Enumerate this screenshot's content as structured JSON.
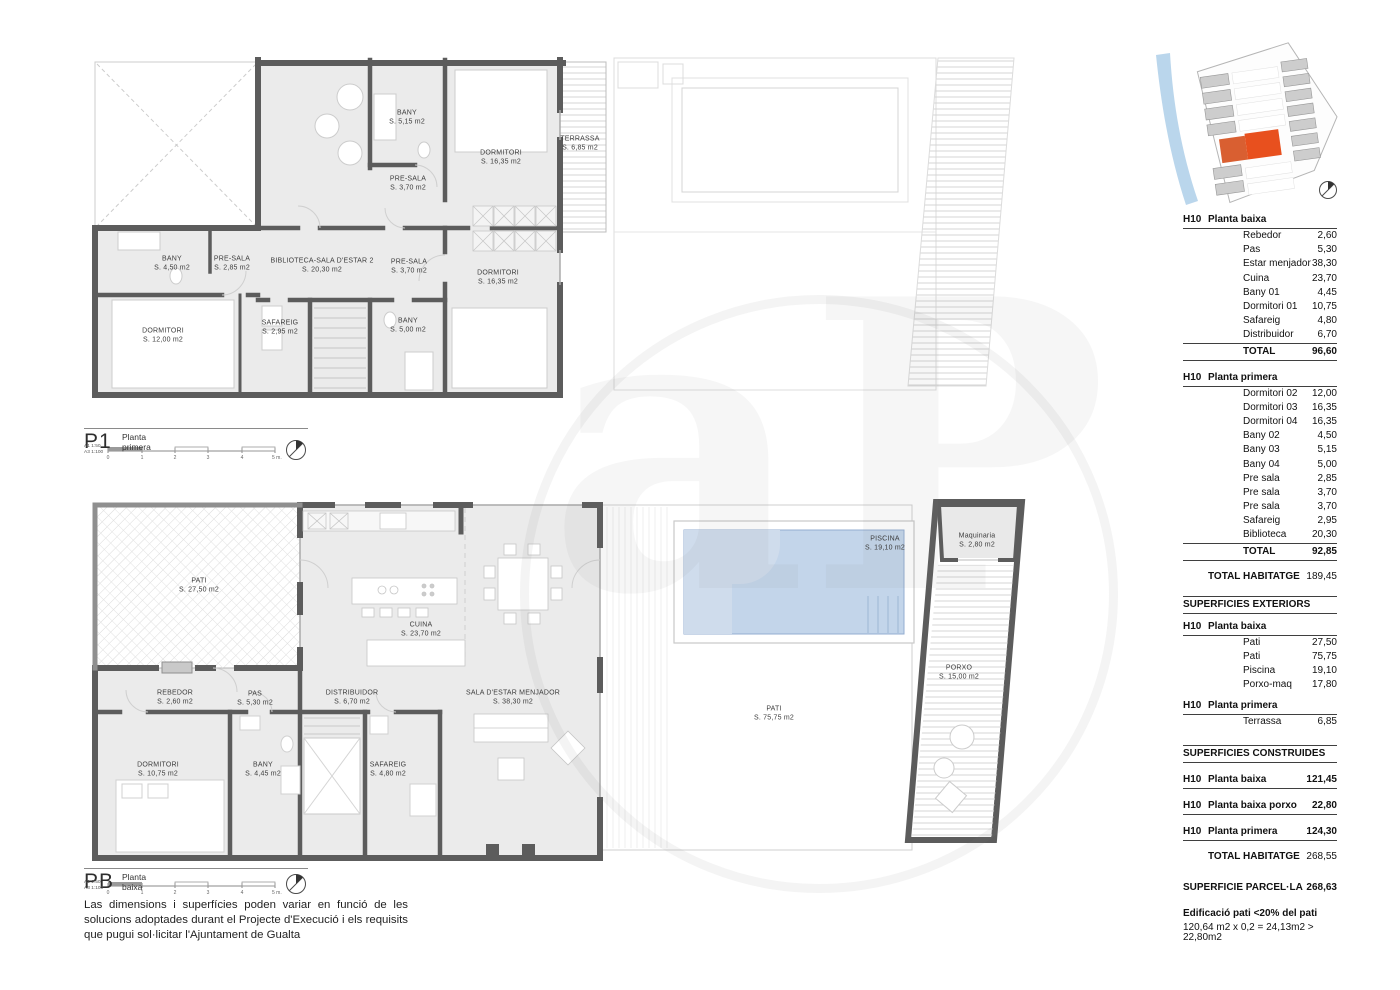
{
  "watermark": {
    "text": "aP"
  },
  "colors": {
    "wall": "#5c5c5c",
    "room_fill": "#ebebeb",
    "pool": "#c3d5ea",
    "highlight_orange": "#e8511f",
    "river_blue": "#b3d1ea"
  },
  "plans": {
    "p1": {
      "code": "P1",
      "title": "Planta primera",
      "scale_a1": "A1  1:50",
      "scale_a3": "A3  1:100",
      "ticks": [
        "0",
        "1",
        "2",
        "3",
        "4",
        "5 m."
      ],
      "rooms": [
        {
          "name": "BANY",
          "area": "S. 5,15 m2"
        },
        {
          "name": "DORMITORI",
          "area": "S. 16,35 m2"
        },
        {
          "name": "TERRASSA",
          "area": "S. 6,85 m2"
        },
        {
          "name": "PRE-SALA",
          "area": "S. 3,70 m2"
        },
        {
          "name": "BANY",
          "area": "S. 4,50 m2"
        },
        {
          "name": "PRE-SALA",
          "area": "S. 2,85 m2"
        },
        {
          "name": "BIBLIOTECA-SALA D'ESTAR 2",
          "area": "S. 20,30 m2"
        },
        {
          "name": "PRE-SALA",
          "area": "S. 3,70 m2"
        },
        {
          "name": "DORMITORI",
          "area": "S. 16,35 m2"
        },
        {
          "name": "DORMITORI",
          "area": "S. 12,00 m2"
        },
        {
          "name": "SAFAREIG",
          "area": "S. 2,95 m2"
        },
        {
          "name": "BANY",
          "area": "S. 5,00 m2"
        }
      ]
    },
    "pb": {
      "code": "PB",
      "title": "Planta baixa",
      "scale_a1": "A1  1:50",
      "scale_a3": "A3  1:100",
      "ticks": [
        "0",
        "1",
        "2",
        "3",
        "4",
        "5 m."
      ],
      "rooms": [
        {
          "name": "PATI",
          "area": "S. 27,50 m2"
        },
        {
          "name": "PISCINA",
          "area": "S. 19,10 m2"
        },
        {
          "name": "Maquinaria",
          "area": "S. 2,80 m2"
        },
        {
          "name": "CUINA",
          "area": "S. 23,70 m2"
        },
        {
          "name": "REBEDOR",
          "area": "S. 2,60 m2"
        },
        {
          "name": "PAS",
          "area": "S. 5,30 m2"
        },
        {
          "name": "DISTRIBUIDOR",
          "area": "S. 6,70 m2"
        },
        {
          "name": "SALA D'ESTAR MENJADOR",
          "area": "S. 38,30 m2"
        },
        {
          "name": "PATI",
          "area": "S. 75,75 m2"
        },
        {
          "name": "PORXO",
          "area": "S. 15,00 m2"
        },
        {
          "name": "DORMITORI",
          "area": "S. 10,75 m2"
        },
        {
          "name": "BANY",
          "area": "S. 4,45 m2"
        },
        {
          "name": "SAFAREIG",
          "area": "S. 4,80 m2"
        }
      ]
    }
  },
  "disclaimer": "Las dimensions i superfícies poden variar en funció de les solucions adoptades durant el Projecte d'Execució i els requisits que pugui sol·licitar l'Ajuntament de Gualta",
  "panel": {
    "habitatge_pb": {
      "code": "H10",
      "title": "Planta baixa",
      "rows": [
        {
          "label": "Rebedor",
          "value": "2,60"
        },
        {
          "label": "Pas",
          "value": "5,30"
        },
        {
          "label": "Estar menjador",
          "value": "38,30"
        },
        {
          "label": "Cuina",
          "value": "23,70"
        },
        {
          "label": "Bany 01",
          "value": "4,45"
        },
        {
          "label": "Dormitori 01",
          "value": "10,75"
        },
        {
          "label": "Safareig",
          "value": "4,80"
        },
        {
          "label": "Distribuidor",
          "value": "6,70"
        }
      ],
      "total": {
        "label": "TOTAL",
        "value": "96,60"
      }
    },
    "habitatge_p1": {
      "code": "H10",
      "title": "Planta primera",
      "rows": [
        {
          "label": "Dormitori 02",
          "value": "12,00"
        },
        {
          "label": "Dormitori 03",
          "value": "16,35"
        },
        {
          "label": "Dormitori 04",
          "value": "16,35"
        },
        {
          "label": "Bany 02",
          "value": "4,50"
        },
        {
          "label": "Bany 03",
          "value": "5,15"
        },
        {
          "label": "Bany 04",
          "value": "5,00"
        },
        {
          "label": "Pre sala",
          "value": "2,85"
        },
        {
          "label": "Pre sala",
          "value": "3,70"
        },
        {
          "label": "Pre sala",
          "value": "3,70"
        },
        {
          "label": "Safareig",
          "value": "2,95"
        },
        {
          "label": "Biblioteca",
          "value": "20,30"
        }
      ],
      "total": {
        "label": "TOTAL",
        "value": "92,85"
      }
    },
    "total_habitatge": {
      "label": "TOTAL HABITATGE",
      "value": "189,45"
    },
    "exteriors": {
      "header": "SUPERFICIES EXTERIORS",
      "pb": {
        "code": "H10",
        "title": "Planta baixa",
        "rows": [
          {
            "label": "Pati",
            "value": "27,50"
          },
          {
            "label": "Pati",
            "value": "75,75"
          },
          {
            "label": "Piscina",
            "value": "19,10"
          },
          {
            "label": "Porxo-maq",
            "value": "17,80"
          }
        ]
      },
      "p1": {
        "code": "H10",
        "title": "Planta primera",
        "rows": [
          {
            "label": "Terrassa",
            "value": "6,85"
          }
        ]
      }
    },
    "construides": {
      "header": "SUPERFICIES CONSTRUIDES",
      "rows": [
        {
          "code": "H10",
          "label": "Planta baixa",
          "value": "121,45"
        },
        {
          "code": "H10",
          "label": "Planta baixa porxo",
          "value": "22,80"
        },
        {
          "code": "H10",
          "label": "Planta primera",
          "value": "124,30"
        }
      ],
      "total": {
        "label": "TOTAL HABITATGE",
        "value": "268,55"
      }
    },
    "parcella": {
      "label": "SUPERFICIE PARCEL·LA",
      "value": "268,63"
    },
    "note_title": "Edificació pati <20% del pati",
    "note_text": "120,64 m2 x 0,2 = 24,13m2 > 22,80m2"
  }
}
